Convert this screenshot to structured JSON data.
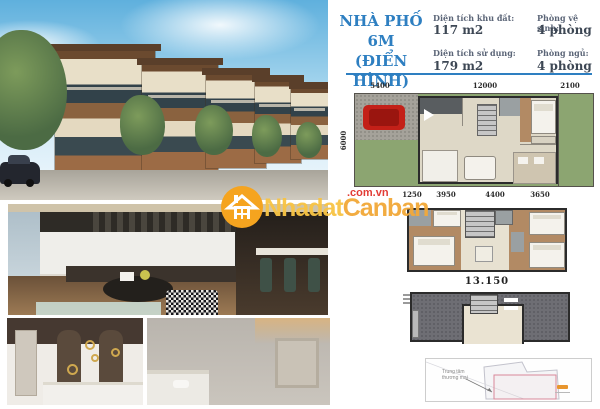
{
  "colors": {
    "accent": "#2e7fc1",
    "brand_orange": "#f5a41f",
    "brand_text1": "#f8c445",
    "brand_text2": "#f2a93a",
    "brand_red": "#e23b35"
  },
  "watermark": {
    "brand_part1": "Nhadat",
    "brand_part2": "Canban",
    "suffix": ".com.vn"
  },
  "header": {
    "title_line1": "NHÀ PHỐ 6M",
    "title_line2": "(ĐIỂN HÌNH)",
    "info": [
      {
        "label": "Diện tích khu đất:",
        "value": "117 m2"
      },
      {
        "label": "Phòng vệ sinh:",
        "value": "4 phòng"
      },
      {
        "label": "Diện tích sử dụng:",
        "value": "179 m2"
      },
      {
        "label": "Phòng ngủ:",
        "value": "4 phòng"
      }
    ]
  },
  "floor_plan_1": {
    "dims_top": [
      "5400",
      "12000",
      "2100"
    ],
    "dim_left": "6000",
    "dims_bottom": [
      "1250",
      "3950",
      "4400",
      "3650"
    ]
  },
  "floor_plan_2": {
    "total_width_label": "13.150"
  },
  "site_map": {
    "annotation_line1": "Trung tâm",
    "annotation_line2": "thương mại"
  }
}
